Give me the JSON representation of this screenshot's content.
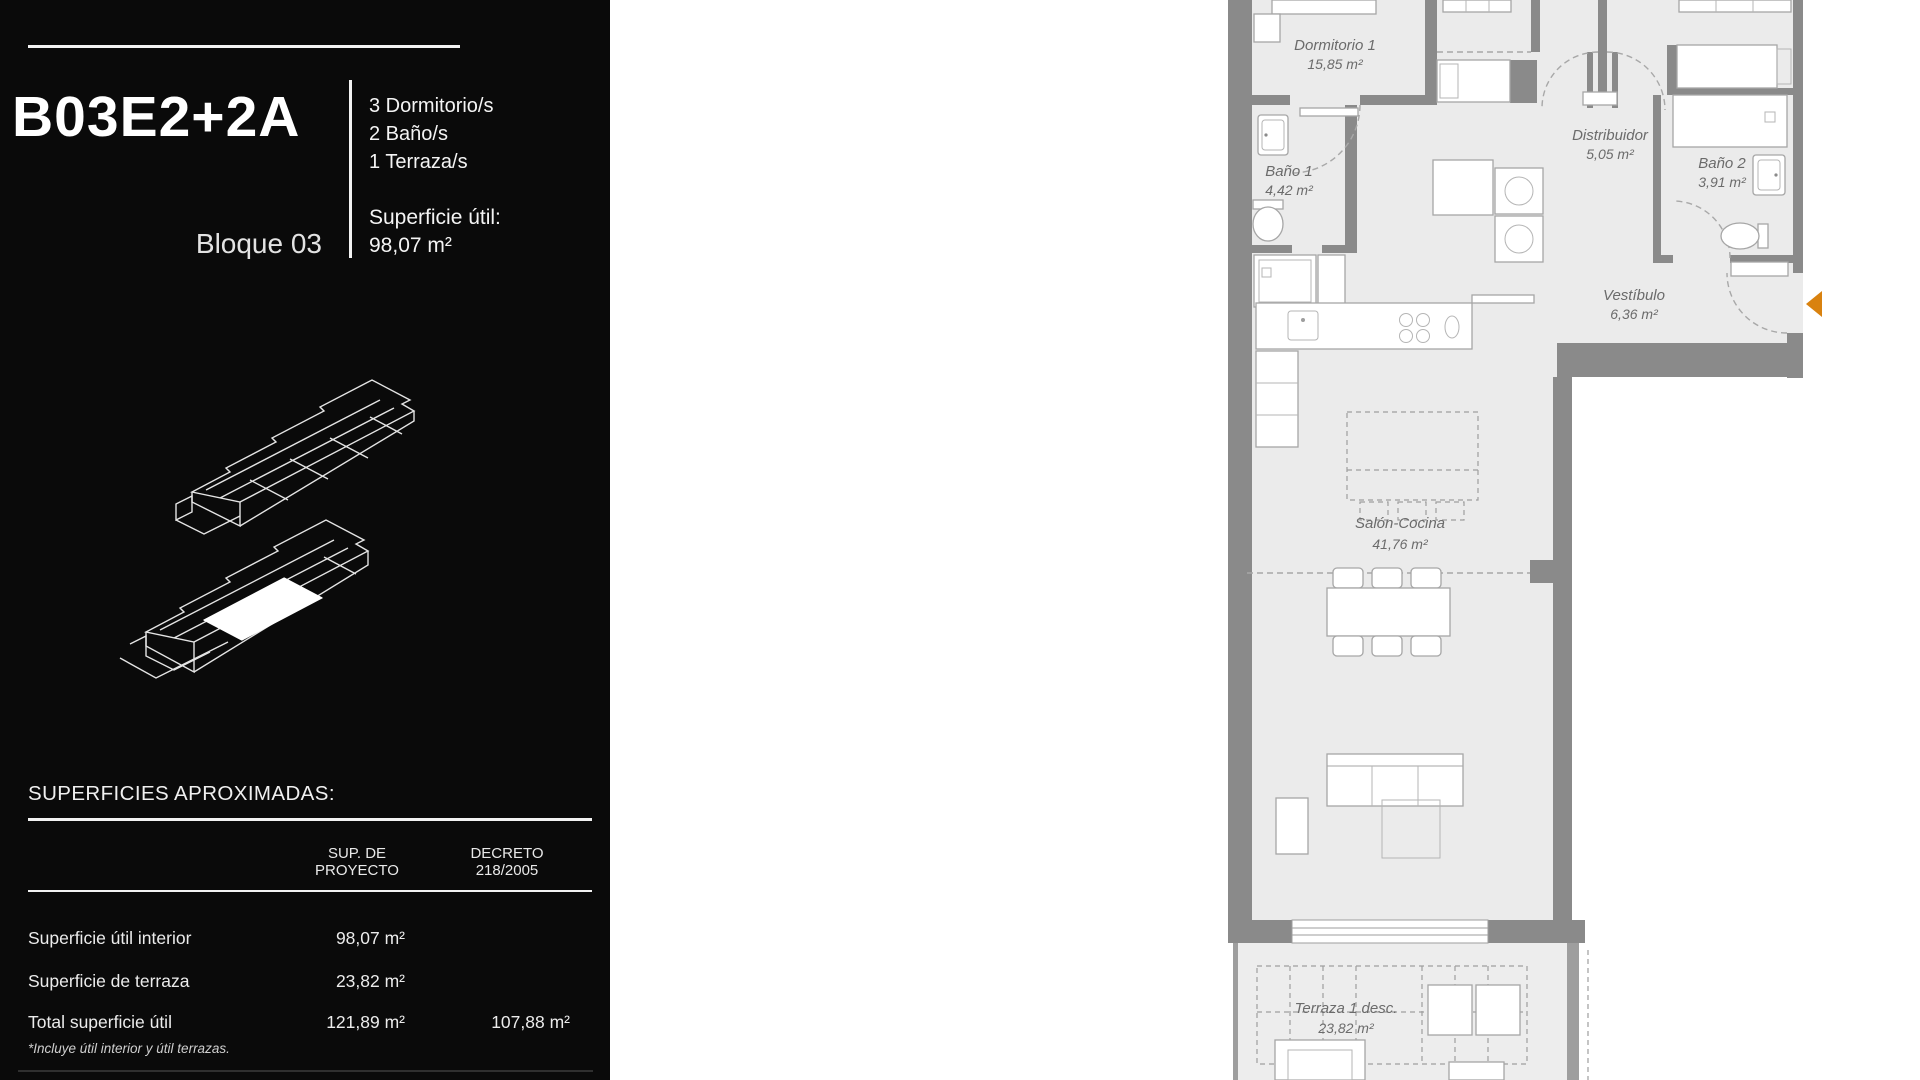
{
  "colors": {
    "sidebar_bg": "#0a0a0a",
    "floor": "#ebebeb",
    "wall": "#8a8a8a",
    "entrance_arrow": "#d9820f",
    "plan_label": "#6b6b6b"
  },
  "sidebar": {
    "unit_code": "B03E2+2A",
    "features": [
      "3 Dormitorio/s",
      "2 Baño/s",
      "1 Terraza/s"
    ],
    "block_label": "Bloque 03",
    "usable_area_label": "Superficie útil:",
    "usable_area_value": "98,07 m²",
    "surfaces_heading": "SUPERFICIES APROXIMADAS:",
    "table": {
      "col_project_line1": "SUP. DE",
      "col_project_line2": "PROYECTO",
      "col_decree_line1": "DECRETO",
      "col_decree_line2": "218/2005",
      "rows": [
        {
          "label": "Superficie útil interior",
          "project": "98,07 m²",
          "decree": ""
        },
        {
          "label": "Superficie de terraza",
          "project": "23,82 m²",
          "decree": ""
        },
        {
          "label": "Total superficie útil",
          "project": "121,89 m²",
          "decree": "107,88 m²"
        }
      ],
      "footnote": "*Incluye útil interior y útil terrazas."
    }
  },
  "floor_plan": {
    "entrance_marker": "entrance-arrow",
    "rooms": [
      {
        "name": "Dormitorio 1",
        "area": "15,85 m²"
      },
      {
        "name": "Baño 1",
        "area": "4,42 m²"
      },
      {
        "name": "Distribuidor",
        "area": "5,05 m²"
      },
      {
        "name": "Baño 2",
        "area": "3,91 m²"
      },
      {
        "name": "Vestíbulo",
        "area": "6,36 m²"
      },
      {
        "name": "Salón-Cocina",
        "area": "41,76 m²"
      },
      {
        "name": "Terraza 1 desc.",
        "area": "23,82 m²"
      }
    ]
  }
}
